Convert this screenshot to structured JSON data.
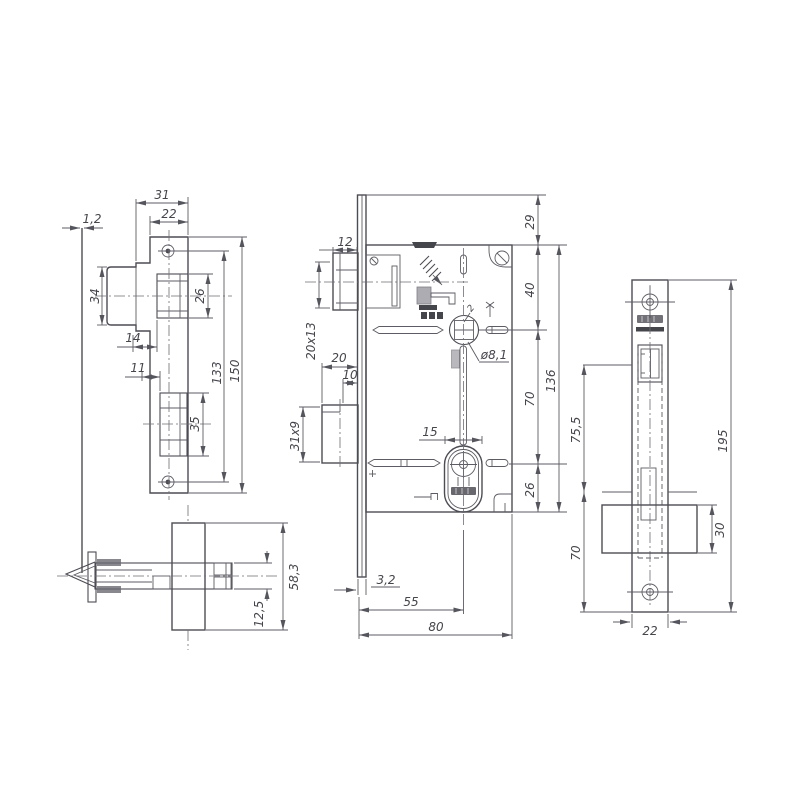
{
  "app": {
    "background": "#ffffff",
    "line_color": "#4c4c54",
    "text_color": "#45454c"
  },
  "views": {
    "strike_plate": {
      "label": "strike-plate-front-view",
      "dims": {
        "w_outer": "31",
        "w_inner": "22",
        "thickness": "1,2",
        "box_h": "34",
        "latch_h": "26",
        "latch_off": "14",
        "bolt_off": "11",
        "bolt_h": "35",
        "holes": "133",
        "total_h": "150"
      }
    },
    "latch_assembly": {
      "label": "latch-bolt-section-view",
      "dims": {
        "block": "58,3",
        "bolt": "12,5"
      }
    },
    "lock_body": {
      "label": "lock-body-side-view",
      "dims": {
        "latch_proj": "12",
        "latch_sec": "20x13",
        "bolt_ext": "20",
        "bolt_proj": "10",
        "bolt_sec": "31x9",
        "cyl_w": "15",
        "spindle": "ø8,1",
        "small": "2",
        "top": "29",
        "upper": "40",
        "mid": "70",
        "lower": "26",
        "case_h": "136",
        "face_t": "3,2",
        "backset": "55",
        "depth": "80"
      }
    },
    "faceplate": {
      "label": "faceplate-front-view",
      "dims": {
        "upper": "75,5",
        "lower": "70",
        "bolt_h": "30",
        "total_h": "195",
        "width": "22"
      }
    }
  }
}
